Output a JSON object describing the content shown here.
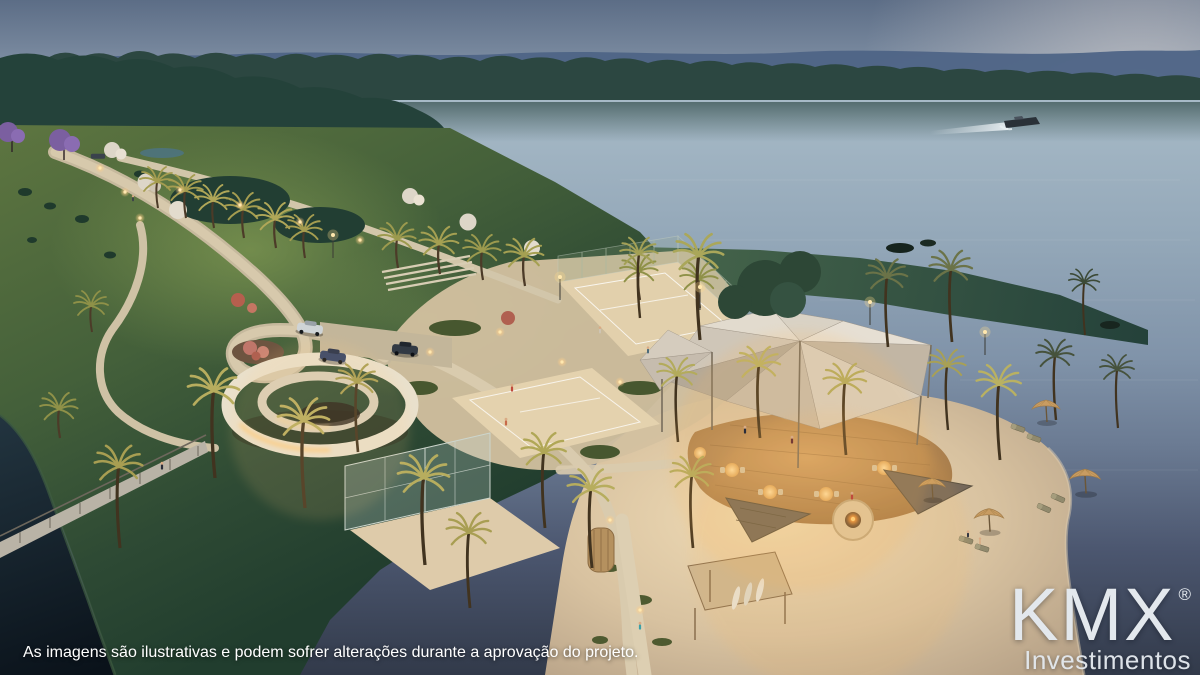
{
  "overlay": {
    "disclaimer": "As imagens são ilustrativas e podem sofrer alterações durante a aprovação do projeto."
  },
  "brand": {
    "name": "KMX",
    "registered_mark": "®",
    "tagline": "Investimentos",
    "text_color": "#e6ebf0"
  },
  "scene": {
    "type": "aerial dusk architectural rendering",
    "subject": "lakefront leisure club with beach, sport courts and shade sails",
    "elements": [
      "dusk sky",
      "distant wooded ridge",
      "lake",
      "speedboat with wake",
      "lawn hill",
      "illuminated winding paths",
      "pedestrian bridge",
      "spiral access ramp",
      "parking with cars",
      "beach tennis courts",
      "glass-walled court",
      "tensile shade sails",
      "round bar on wood deck",
      "fire pit lounge",
      "triangle shade canopies",
      "surfboard kiosk",
      "beach with umbrellas and loungers",
      "palm trees with uplights",
      "purple and white flowering trees"
    ],
    "palette": {
      "sky_top": "#5c6d86",
      "sky_horizon": "#a9b4c2",
      "water_light": "#a7bac7",
      "water_dark": "#323a4a",
      "treeline": "#2c4741",
      "lawn": "#44603a",
      "sand": "#dfc9a6",
      "path": "#d2c6aa",
      "canopy": "#d8cfc0",
      "deck": "#c89a62",
      "warm_light": "#ffd793",
      "umbrella": "#c89c62"
    }
  }
}
